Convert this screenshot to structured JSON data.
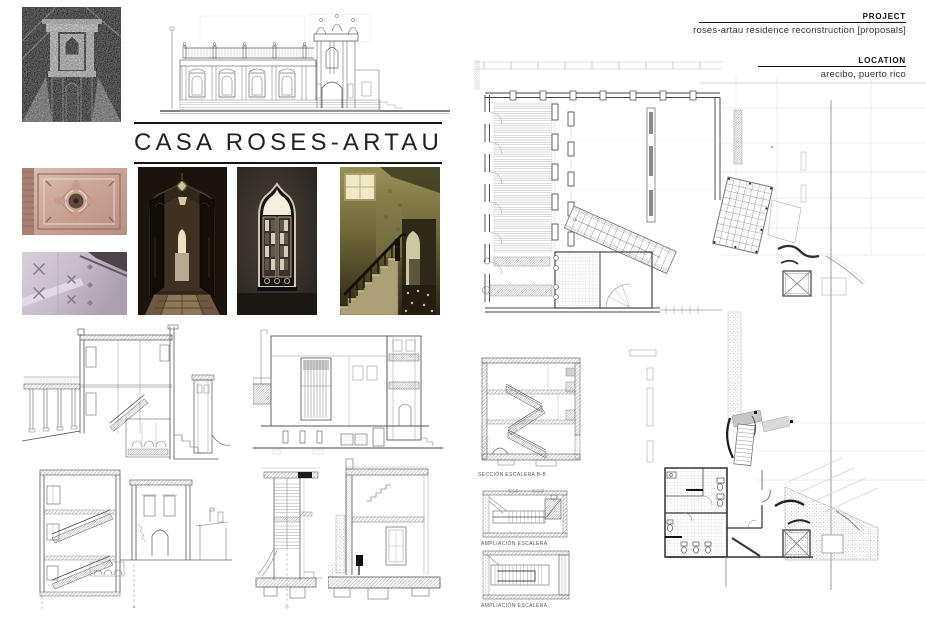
{
  "header": {
    "project_label": "PROJECT",
    "project_value": "roses-artau residence reconstruction [proposals]",
    "location_label": "LOCATION",
    "location_value": "arecibo, puerto rico"
  },
  "title": "CASA ROSES-ARTAU",
  "captions": [
    {
      "text": "SECCIÓN ESCALERA B-B"
    },
    {
      "text": "AMPLIACIÓN ESCALERA"
    },
    {
      "text": "AMPLIACIÓN ESCALERA"
    }
  ],
  "colors": {
    "ink": "#111111",
    "drawing_line": "#666666",
    "grid_line": "#cccccc"
  }
}
